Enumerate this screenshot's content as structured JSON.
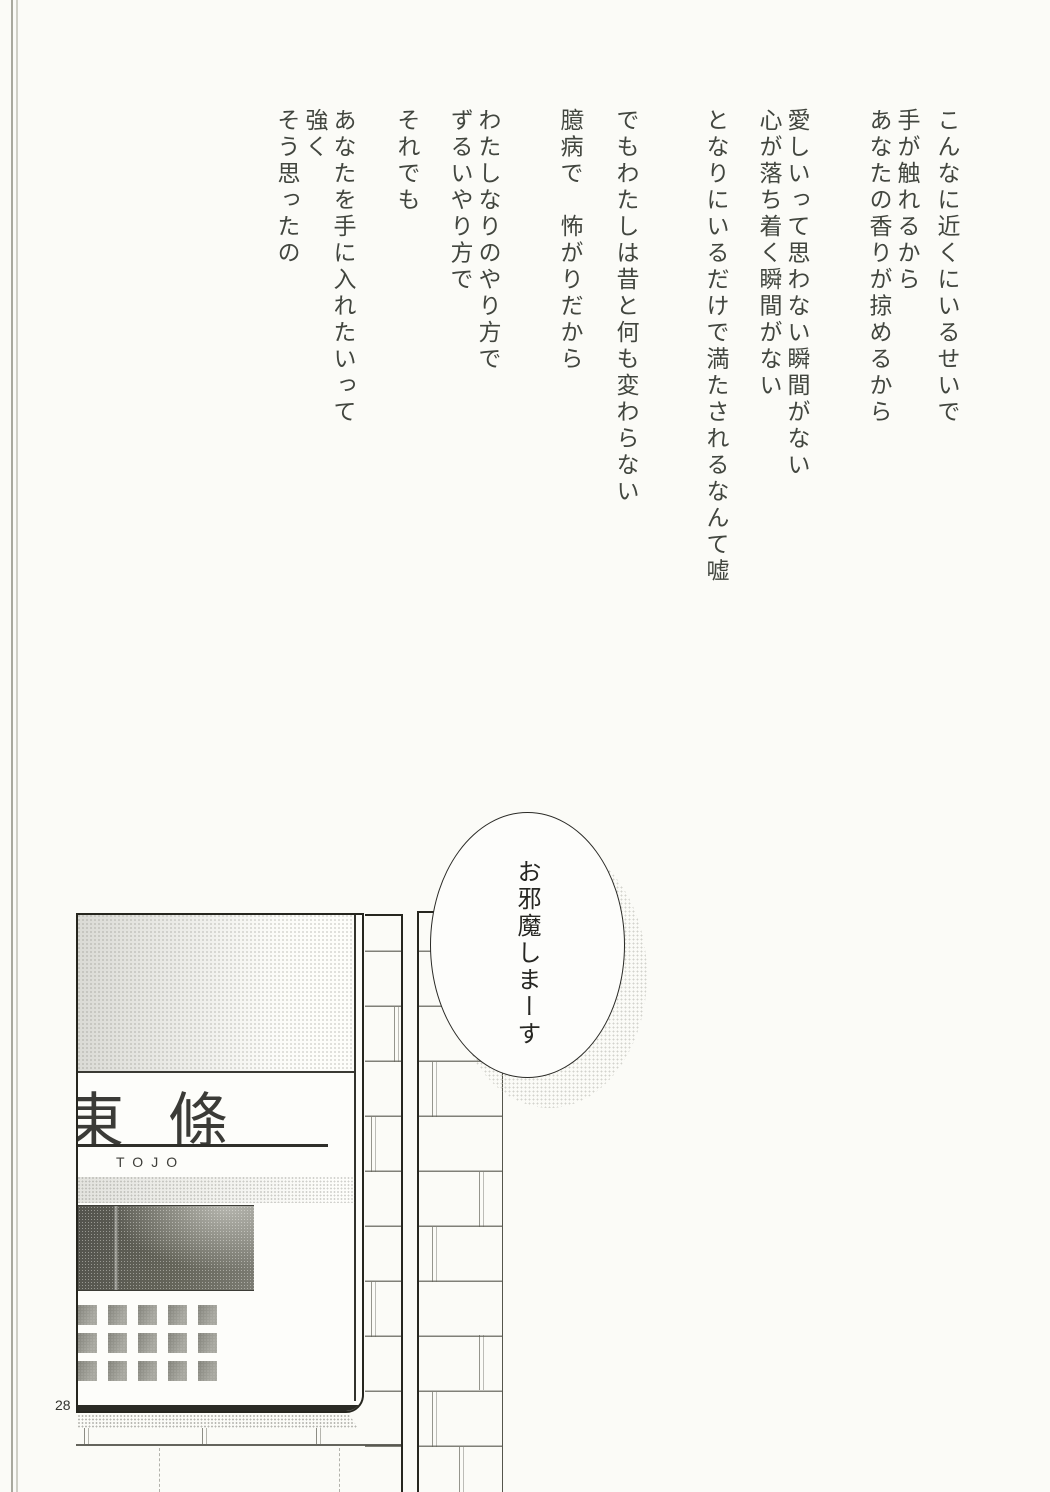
{
  "page": {
    "number": "28",
    "background": "#fbfbf7"
  },
  "poem": {
    "lines": [
      "こんなに近くにいるせいで",
      "手が触れるから",
      "あなたの香りが掠めるから",
      "愛しいって思わない瞬間がない",
      "心が落ち着く瞬間がない",
      "となりにいるだけで満たされるなんて嘘",
      "でもわたしは昔と何も変わらない",
      "臆病で　怖がりだから",
      "わたしなりのやり方で",
      "ずるいやり方で",
      "それでも",
      "あなたを手に入れたいって",
      "強く",
      "そう思ったの"
    ]
  },
  "speech_bubble": {
    "text": "お邪魔しまーす"
  },
  "nameplate": {
    "kanji": "東條",
    "romaji": "TOJO"
  },
  "colors": {
    "ink": "#42463f",
    "panel_border": "#26261f",
    "screen_dark": "#53534d",
    "halftone_gray": "#8c8c82",
    "page_bg": "#fbfbf7"
  }
}
